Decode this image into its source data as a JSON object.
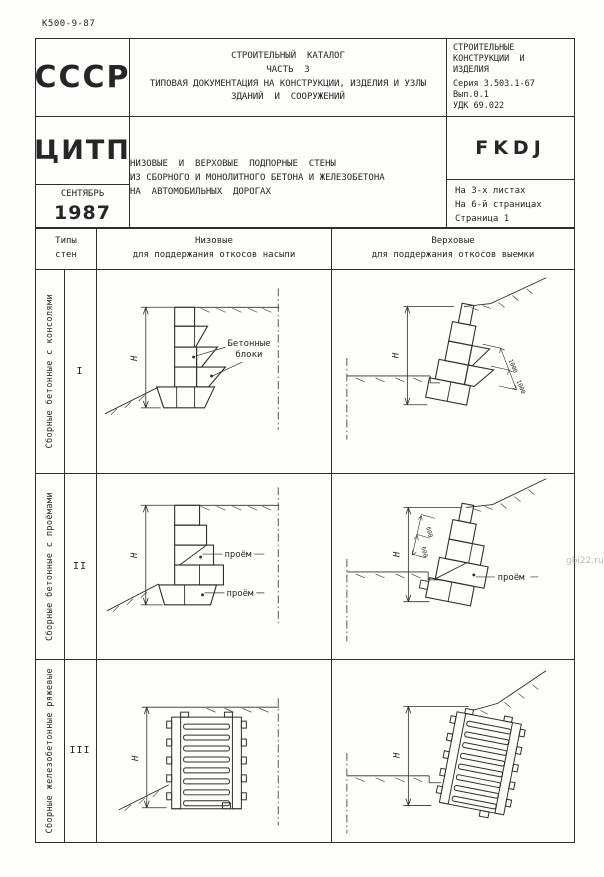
{
  "page": {
    "doc_code": "К500-9-87",
    "watermark": "gbi22.ru"
  },
  "header": {
    "country": "СССР",
    "publisher": "ЦИТП",
    "month": "СЕНТЯБРЬ",
    "year": "1987",
    "catalog": {
      "line1": "СТРОИТЕЛЬНЫЙ  КАТАЛОГ",
      "line2": "ЧАСТЬ  3",
      "line3": "ТИПОВАЯ ДОКУМЕНТАЦИЯ НА КОНСТРУКЦИИ, ИЗДЕЛИЯ И УЗЛЫ",
      "line4": "ЗДАНИЙ  И  СООРУЖЕНИЙ"
    },
    "classification": {
      "line1": "СТРОИТЕЛЬНЫЕ",
      "line2": "КОНСТРУКЦИИ  И",
      "line3": "ИЗДЕЛИЯ",
      "series": "Серия 3.503.1-67",
      "issue": "Вып.0.1",
      "udk": "УДК 69.022"
    },
    "code": "FKDJ",
    "sheet_info": {
      "line1": "На 3-х листах",
      "line2": "На 6-й страницах",
      "line3": "Страница 1"
    },
    "title": {
      "line1": "НИЗОВЫЕ  И  ВЕРХОВЫЕ  ПОДПОРНЫЕ  СТЕНЫ",
      "line2": "ИЗ СБОРНОГО И МОНОЛИТНОГО БЕТОНА И ЖЕЛЕЗОБЕТОНА",
      "line3": "НА  АВТОМОБИЛЬНЫХ  ДОРОГАХ"
    }
  },
  "table": {
    "headers": {
      "types_line1": "Типы",
      "types_line2": "стен",
      "low_line1": "Низовые",
      "low_line2": "для поддержания откосов насыпи",
      "high_line1": "Верховые",
      "high_line2": "для поддержания откосов выемки"
    },
    "rows": [
      {
        "category": "Сборные бетонные с консолями",
        "type": "I"
      },
      {
        "category": "Сборные бетонные с проёмами",
        "type": "II"
      },
      {
        "category": "Сборные железобетонные ряжевые",
        "type": "III"
      }
    ]
  },
  "drawings": {
    "height_symbol": "Н",
    "row1_low": {
      "label_line1": "Бетонные",
      "label_line2": "блоки"
    },
    "row1_high": {
      "dim1": "1000",
      "dim2": "1000"
    },
    "row2_low": {
      "opening1": "проём",
      "opening2": "проём"
    },
    "row2_high": {
      "opening": "проём",
      "dim1": "600",
      "dim2": "600"
    }
  }
}
